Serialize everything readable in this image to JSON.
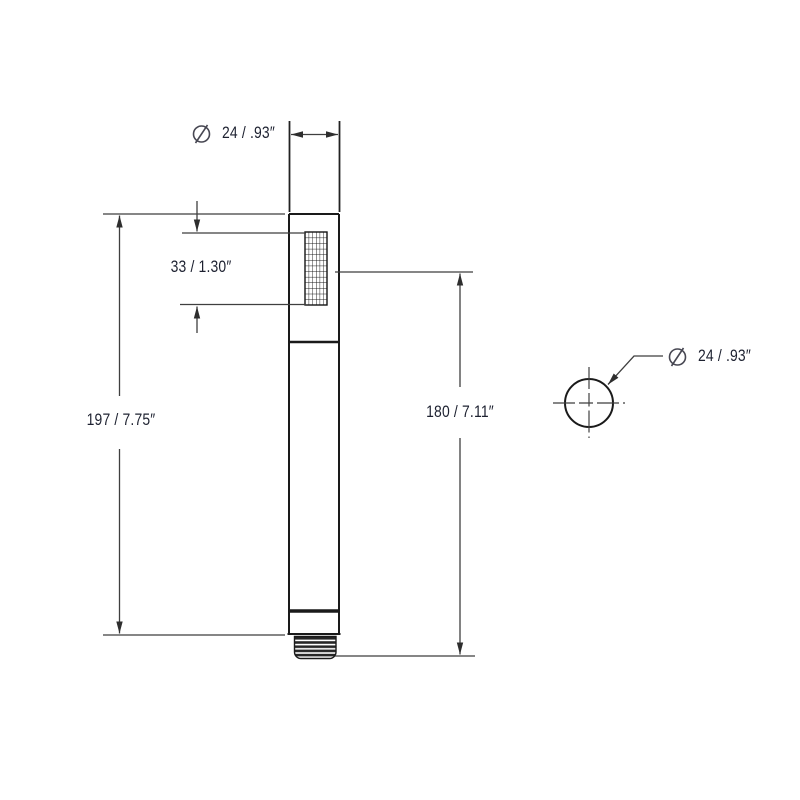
{
  "drawing": {
    "elevation_view": {
      "diameter_label": {
        "symbol": "⌀",
        "text": "24 / .93″"
      },
      "spray_face_label": {
        "text": "33 / 1.30″"
      },
      "overall_length_label": {
        "text": "197 / 7.75″"
      },
      "face_to_outlet_label": {
        "text": "180 / 7.11″"
      }
    },
    "top_view": {
      "diameter_label": {
        "symbol": "⌀",
        "text": "24 / .93″"
      }
    },
    "colors": {
      "object_line": "#1a1a1a",
      "dimension_line": "#3f3f3f",
      "label_text": "#1d2130",
      "background": "#ffffff"
    }
  }
}
